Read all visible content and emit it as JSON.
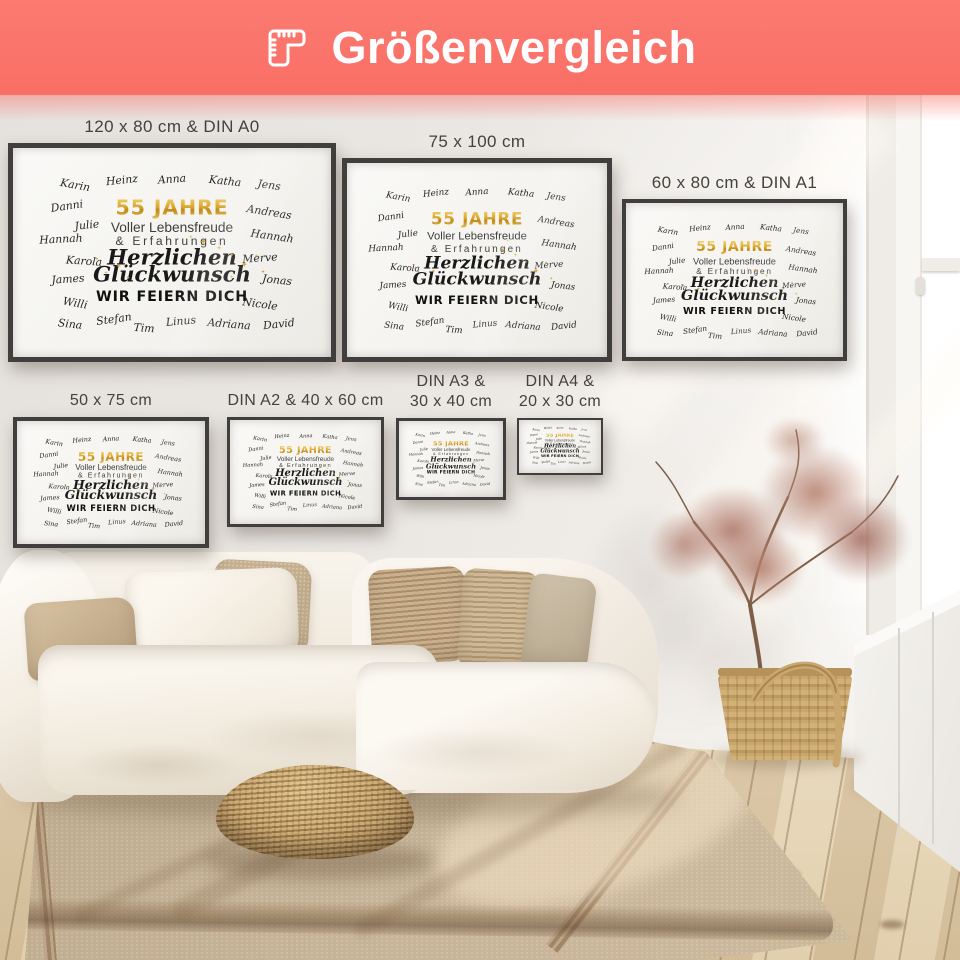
{
  "banner": {
    "title": "Größenvergleich",
    "icon": "corner-ruler-icon",
    "bg_color": "#F9716A",
    "text_color": "#FFFFFF"
  },
  "posters": [
    {
      "name": "poster-120x80-din-a0",
      "label": "120 x 80 cm & DIN A0"
    },
    {
      "name": "poster-75x100",
      "label": "75 x 100 cm"
    },
    {
      "name": "poster-60x80-din-a1",
      "label": "60 x 80 cm & DIN A1"
    },
    {
      "name": "poster-50x75",
      "label": "50 x 75 cm"
    },
    {
      "name": "poster-din-a2-40x60",
      "label": "DIN A2 & 40 x 60 cm"
    },
    {
      "name": "poster-din-a3-30x40",
      "label": "DIN A3 &\n30 x 40 cm"
    },
    {
      "name": "poster-din-a4-20x30",
      "label": "DIN A4 &\n20 x 30 cm"
    }
  ],
  "poster_design": {
    "headline": "55 JAHRE",
    "subline1": "Voller Lebensfreude",
    "subline2": "& Erfahrungen",
    "script1": "Herzlichen",
    "script2": "Glückwunsch",
    "footer": "WIR FEIERN DICH",
    "colors": {
      "gold": "#D8A52A",
      "gold_light": "#F1C75F",
      "text_dark": "#3E3E3E",
      "script_black": "#191919",
      "names": "#262626",
      "paper": "#F7F6F3",
      "frame": "#403F3D"
    },
    "names": [
      {
        "t": "Karin",
        "x": 19,
        "y": 17.5,
        "r": 10
      },
      {
        "t": "Heinz",
        "x": 34,
        "y": 15,
        "r": -6
      },
      {
        "t": "Anna",
        "x": 50,
        "y": 14.5,
        "r": -4
      },
      {
        "t": "Katha",
        "x": 67,
        "y": 15.5,
        "r": 6
      },
      {
        "t": "Jens",
        "x": 81,
        "y": 17.5,
        "r": 8
      },
      {
        "t": "Danni",
        "x": 16.5,
        "y": 28,
        "r": -8
      },
      {
        "t": "Andreas",
        "x": 81,
        "y": 30.5,
        "r": 9
      },
      {
        "t": "Julie",
        "x": 23,
        "y": 37,
        "r": -6
      },
      {
        "t": "Hannah",
        "x": 14.5,
        "y": 44,
        "r": -3
      },
      {
        "t": "Hannah",
        "x": 82,
        "y": 42.5,
        "r": 8
      },
      {
        "t": "Karola",
        "x": 22,
        "y": 54.5,
        "r": 4
      },
      {
        "t": "Merve",
        "x": 78,
        "y": 53,
        "r": -4
      },
      {
        "t": "James",
        "x": 17,
        "y": 63.5,
        "r": -4
      },
      {
        "t": "Jonas",
        "x": 83.5,
        "y": 64,
        "r": 6
      },
      {
        "t": "Willi",
        "x": 19,
        "y": 75,
        "r": 10
      },
      {
        "t": "Nicole",
        "x": 78,
        "y": 75.5,
        "r": 8
      },
      {
        "t": "Sina",
        "x": 17.5,
        "y": 85.5,
        "r": 6
      },
      {
        "t": "Stefan",
        "x": 31.5,
        "y": 83,
        "r": -8
      },
      {
        "t": "Tim",
        "x": 41,
        "y": 87.5,
        "r": 4
      },
      {
        "t": "Linus",
        "x": 53,
        "y": 84,
        "r": -5
      },
      {
        "t": "Adriana",
        "x": 68,
        "y": 85.5,
        "r": 5
      },
      {
        "t": "David",
        "x": 84,
        "y": 85.5,
        "r": -6
      }
    ],
    "sparkles": [
      {
        "g": "✦",
        "x": 60,
        "y": 45,
        "s": 0.8
      },
      {
        "g": "+",
        "x": 65,
        "y": 48,
        "s": 0.7
      },
      {
        "g": "✦",
        "x": 69,
        "y": 52,
        "s": 0.55
      },
      {
        "g": "+",
        "x": 56,
        "y": 43,
        "s": 0.5
      },
      {
        "g": "✦",
        "x": 73,
        "y": 56,
        "s": 0.85
      },
      {
        "g": "+",
        "x": 77,
        "y": 52,
        "s": 0.6
      },
      {
        "g": "✦",
        "x": 33,
        "y": 57,
        "s": 0.65
      },
      {
        "g": "+",
        "x": 29,
        "y": 61,
        "s": 0.55
      },
      {
        "g": "✦",
        "x": 36,
        "y": 63,
        "s": 0.5
      },
      {
        "g": "+",
        "x": 62,
        "y": 40,
        "s": 0.5
      },
      {
        "g": "✦",
        "x": 79,
        "y": 60,
        "s": 0.5
      },
      {
        "g": "+",
        "x": 69,
        "y": 63,
        "s": 0.55
      },
      {
        "g": "✦",
        "x": 26,
        "y": 54,
        "s": 0.45
      }
    ]
  },
  "scene": {
    "colors": {
      "wall": "#EAE7E3",
      "floor_wood": "#E2D2B4",
      "rug": "#C1AE90",
      "rug_border": "#96785A",
      "couch": "#F6F1E8",
      "pillow_beige": "#C6B190",
      "pillow_knit": "#BA9E7B",
      "pouf_rattan": "#B8905C",
      "basket_wicker": "#C9A76F",
      "plant_foliage": "#B07A6A",
      "window_light": "#FFFFFF"
    }
  }
}
